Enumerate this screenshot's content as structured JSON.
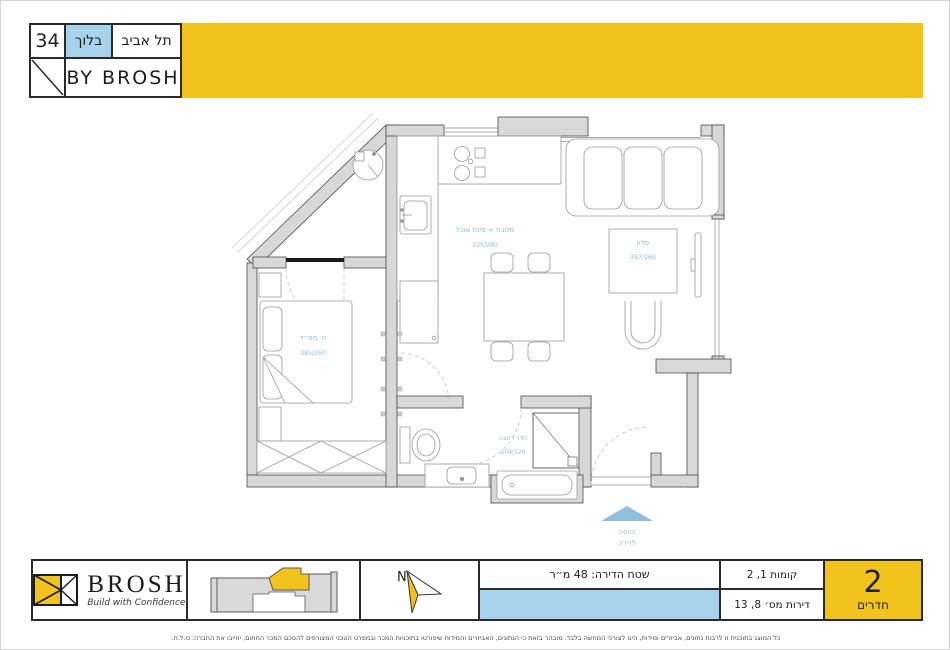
{
  "header": {
    "number": "34",
    "block": "בלוך",
    "city": "תל אביב",
    "byline": "BY BROSH"
  },
  "plan": {
    "rooms": [
      {
        "name": "מטבח + פינת אוכל",
        "dims": "325/280"
      },
      {
        "name": "סלון",
        "dims": "397/260"
      },
      {
        "name": "ח. ממ״ד",
        "dims": "385/260"
      },
      {
        "name": "חדר רחצה",
        "dims": "204/120"
      }
    ],
    "entrance": {
      "line1": "כניסה",
      "line2": "לדירה"
    }
  },
  "footer": {
    "brand": {
      "name": "BROSH",
      "tagline": "Build with Confidence"
    },
    "north": "N",
    "area": "שטח הדירה: 48 מ״ר",
    "floors": "קומות 1, 2",
    "apartments": "דירות מס׳ 8, 13",
    "rooms_count": "2",
    "rooms_label": "חדרים"
  },
  "disclaimer": "כל המוצג בתוכנית זו לרבות נתונים, אביזרים ומידות, הינו לצורכי המחשה בלבד. מובהר בזאת כי הנתונים, האביזרים והמידות שיפורטו בתוכניות המכר ובמפרט הטכני המצורפים להסכם המכר החתום, יחייבו את החברה. ט.ל.ח.",
  "colors": {
    "accent_yellow": "#F2C31D",
    "light_blue": "#A8D3ED",
    "label_blue": "#8CBCE8",
    "wall_gray": "#D8D8D8"
  }
}
